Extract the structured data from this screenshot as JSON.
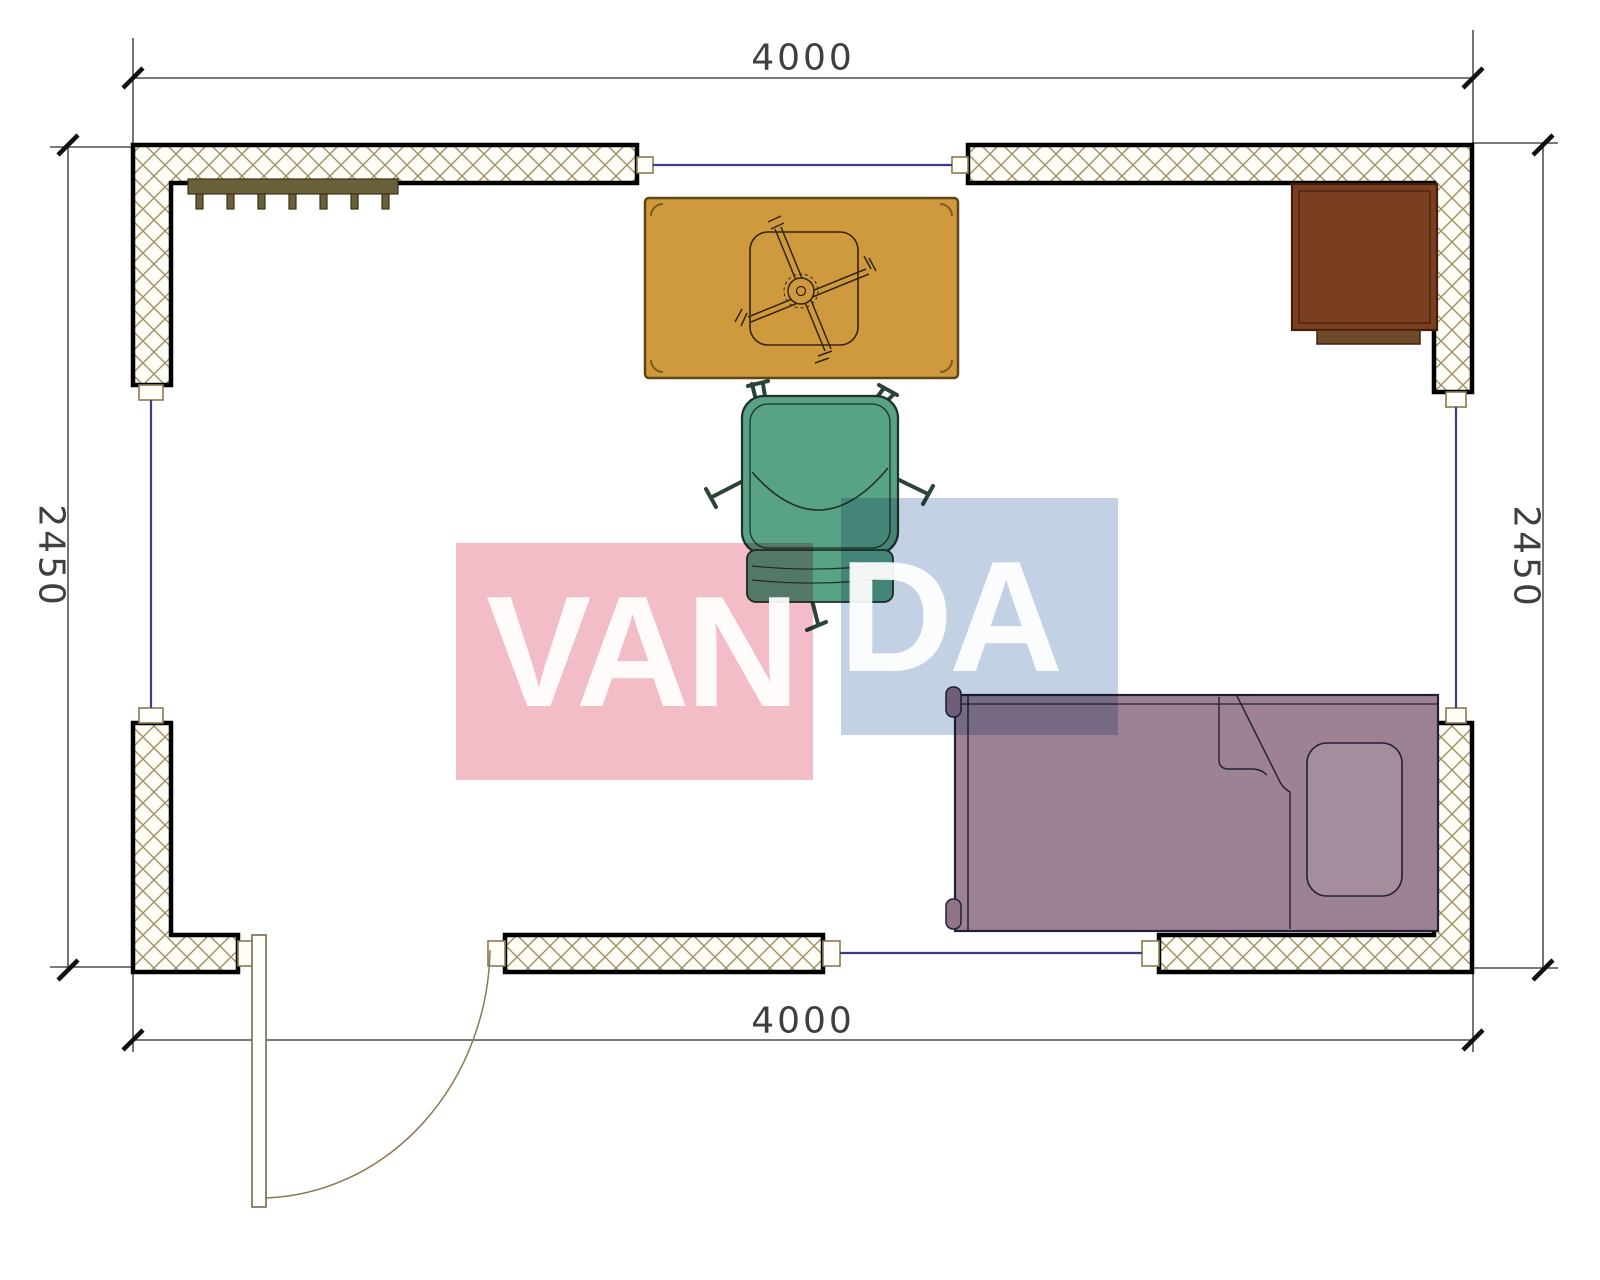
{
  "document": {
    "type": "floor-plan",
    "units": "mm"
  },
  "dimensions": {
    "top": "4000",
    "bottom": "4000",
    "left": "2450",
    "right": "2450"
  },
  "watermark": {
    "word": "VANDA",
    "part1": "VAN",
    "part2": "DA",
    "pink_color": "#f3bdc7",
    "blue_color": "#c3d1e5",
    "text_color": "#ffffff"
  },
  "colors": {
    "wall_outline": "#000000",
    "wall_hatch": "#a08f62",
    "window_glass": "#3c3c88",
    "door_frame": "#8a7a50",
    "radiator": "#6a603a",
    "table": "#cf993d",
    "chair": "#58a285",
    "desk": "#7c3e21",
    "bed": "#9c8292",
    "pillow": "#a48d9c",
    "dimension_text": "#3f3f3f"
  },
  "furniture": [
    {
      "name": "radiator",
      "color": "#6a603a"
    },
    {
      "name": "table-with-chair-base",
      "color": "#cf993d"
    },
    {
      "name": "armchair",
      "color": "#58a285"
    },
    {
      "name": "corner-desk",
      "color": "#7c3e21"
    },
    {
      "name": "single-bed",
      "color": "#9c8292"
    },
    {
      "name": "door",
      "color": "#8a7a50"
    }
  ]
}
